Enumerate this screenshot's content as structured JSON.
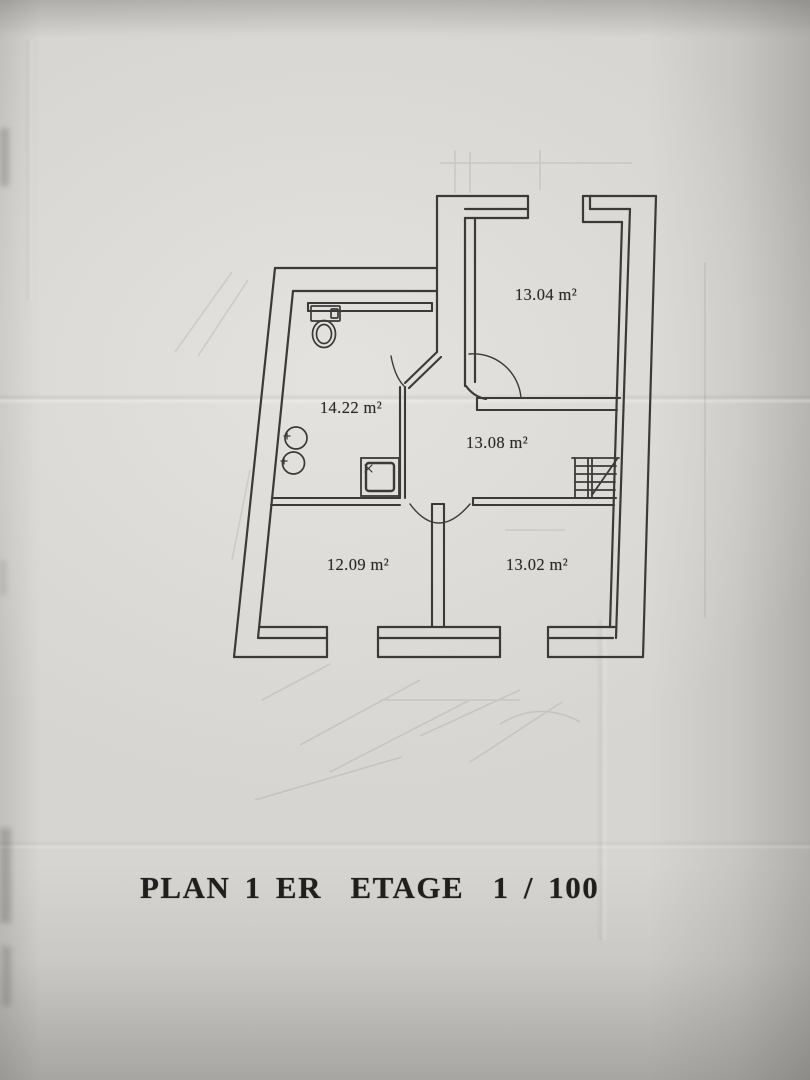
{
  "document": {
    "title": "PLAN 1 ER  ETAGE  1 / 100"
  },
  "plan": {
    "scale": "1 / 100",
    "rooms": [
      {
        "id": "room-top-right",
        "area": "13.04 m²"
      },
      {
        "id": "room-bathroom",
        "area": "14.22 m²"
      },
      {
        "id": "room-hall",
        "area": "13.08 m²"
      },
      {
        "id": "room-bottom-left",
        "area": "12.09 m²"
      },
      {
        "id": "room-bottom-right",
        "area": "13.02 m²"
      }
    ],
    "fixtures": [
      "toilet-icon",
      "sink-icon",
      "sink-icon",
      "shower-icon",
      "staircase-icon"
    ],
    "colors": {
      "paper": "#d7d5d1",
      "ink": "#3b3a38",
      "title_ink": "#201f1d"
    }
  }
}
